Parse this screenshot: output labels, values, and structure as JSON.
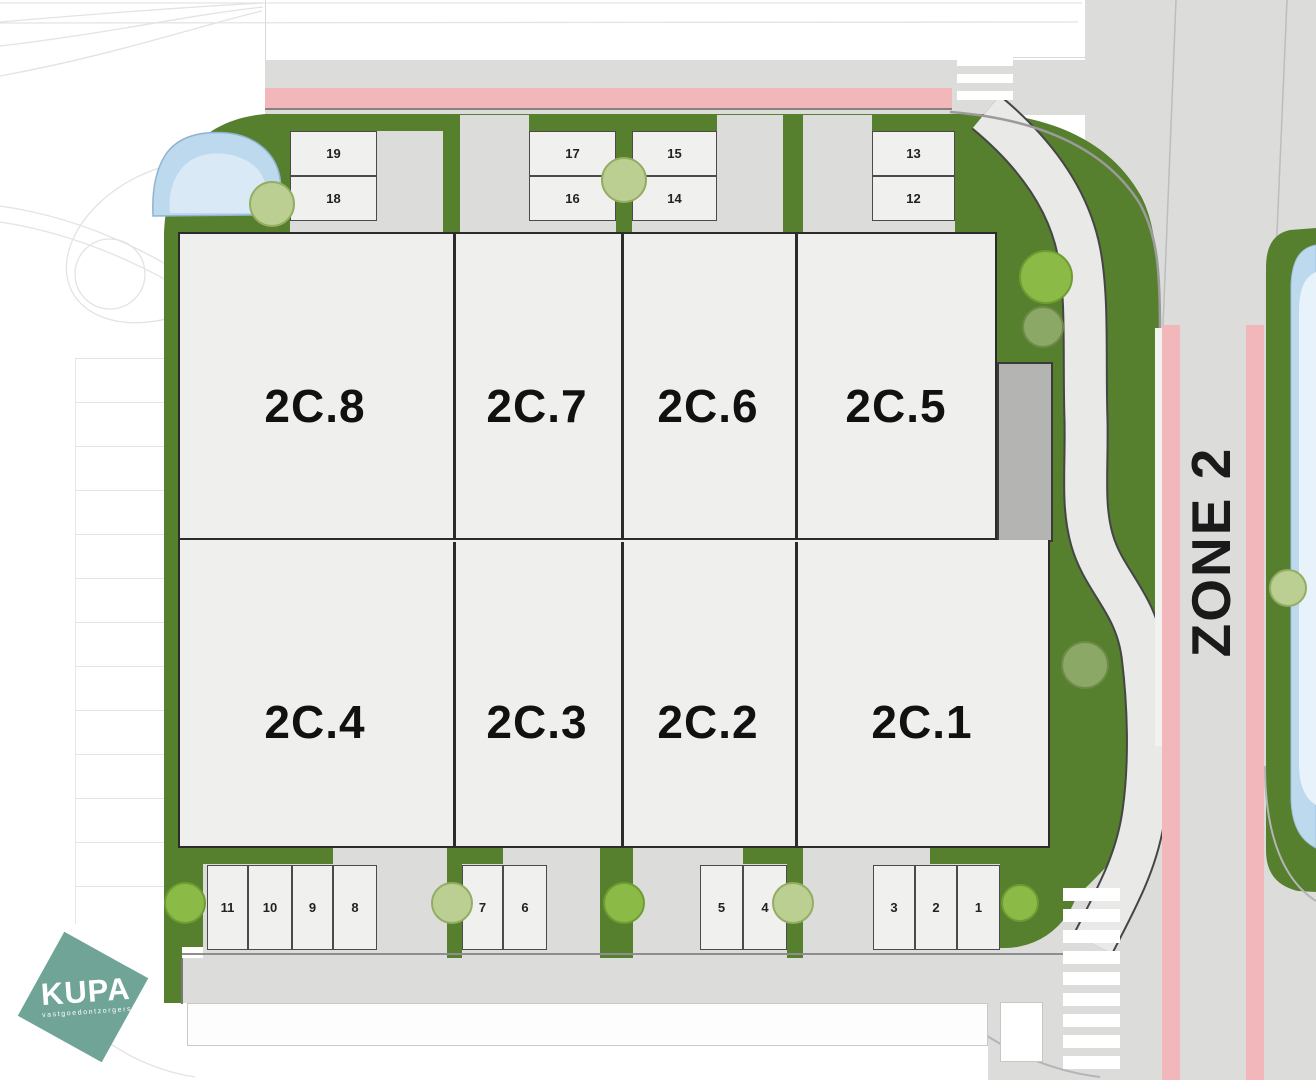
{
  "zone": {
    "label": "ZONE 2"
  },
  "logo": {
    "brand": "KUPA",
    "tagline": "vastgoedontzorgers"
  },
  "units": [
    {
      "id": "2C.8"
    },
    {
      "id": "2C.7"
    },
    {
      "id": "2C.6"
    },
    {
      "id": "2C.5"
    },
    {
      "id": "2C.4"
    },
    {
      "id": "2C.3"
    },
    {
      "id": "2C.2"
    },
    {
      "id": "2C.1"
    }
  ],
  "parking_top": [
    "19",
    "18",
    "17",
    "16",
    "15",
    "14",
    "13",
    "12"
  ],
  "parking_bottom": [
    "11",
    "10",
    "9",
    "8",
    "7",
    "6",
    "5",
    "4",
    "3",
    "2",
    "1"
  ],
  "colors": {
    "grass_green": "#567f2e",
    "road_gray": "#dcdcda",
    "bike_path_pink": "#f1b7bb",
    "water_blue": "#bcd9ee",
    "building_fill": "#efefed",
    "annex_gray": "#b4b4b3",
    "logo_teal": "#6fa497"
  }
}
